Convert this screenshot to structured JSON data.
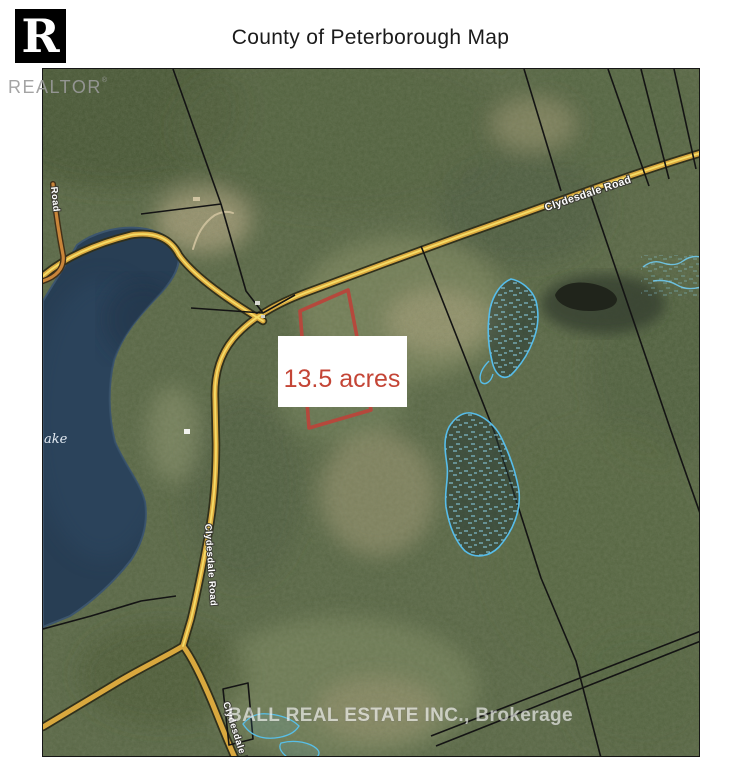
{
  "header": {
    "title": "County of Peterborough Map",
    "logo": {
      "mark_letter": "R",
      "brand": "REALTOR",
      "registered": "®"
    }
  },
  "map": {
    "parcel": {
      "acreage": "13.5 acres"
    },
    "labels": {
      "road_upper": "Clydesdale Road",
      "road_mid_vertical": "Clydesdale Road",
      "road_bottom_vertical": "Clydesdale Road",
      "road_left_partial": "Road",
      "lake_partial": "ake"
    },
    "watermark": "BALL REAL ESTATE INC., Brokerage",
    "colors": {
      "lake": "#283e54",
      "forest_base": "#566442",
      "road_fill": "#d9a83e",
      "road_centerline": "#f5dc66",
      "road_casing": "#30301c",
      "boundary_line": "#141414",
      "subject_parcel_outline": "#b5483c",
      "acreage_text": "#c44536",
      "wetland_outline": "#57bdea",
      "watermark_text": "#ffffff"
    }
  }
}
